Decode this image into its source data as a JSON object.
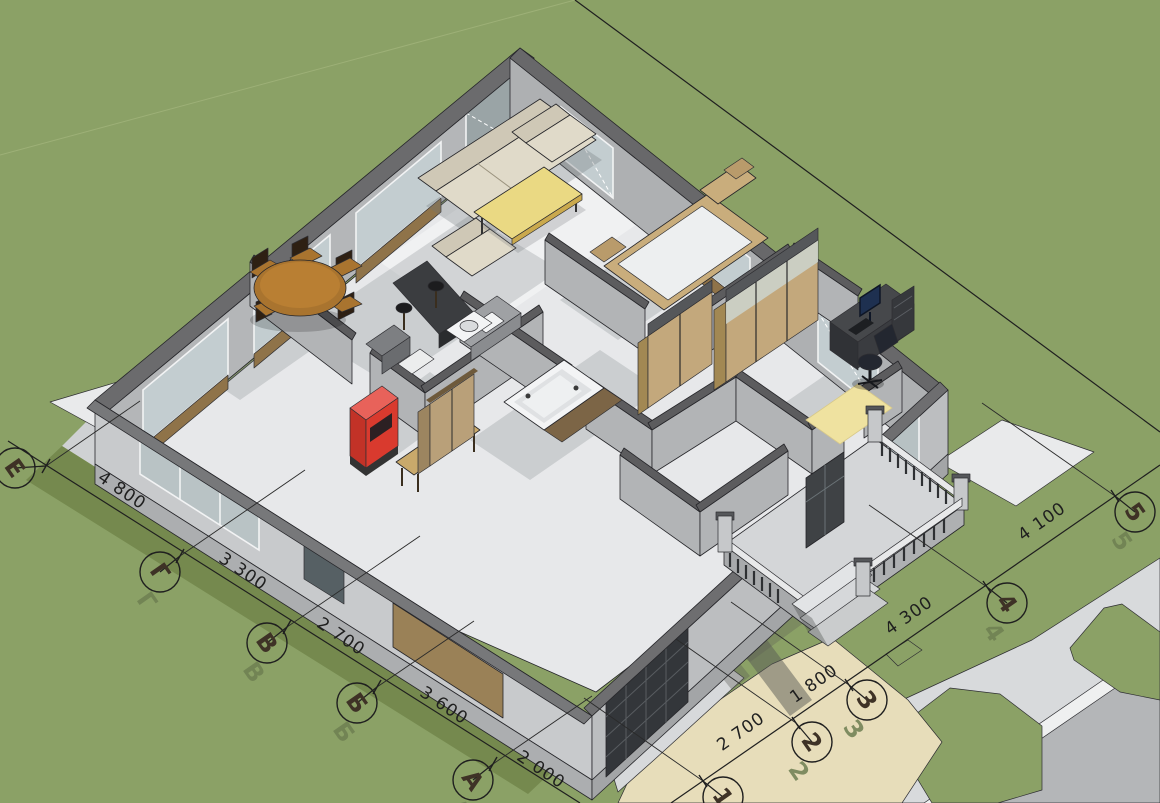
{
  "dimension_labels": {
    "left_chain": [
      "4 800",
      "3 300",
      "2 700",
      "3 600",
      "2 000"
    ],
    "bottom_chain": [
      "2 700",
      "1 800",
      "4 300",
      "4 100"
    ]
  },
  "axis_markers": {
    "left_chain": [
      "Е",
      "Г",
      "В",
      "Б",
      "А"
    ],
    "bottom_chain": [
      "1",
      "2",
      "3",
      "4",
      "5"
    ]
  },
  "colors": {
    "grass": "#8BA166",
    "grass_shadow": "#75894E",
    "path": "#D8DADC",
    "road": "#B4B6B8",
    "driveway": "#E7DDBA",
    "wall_outer": "#C8CACC",
    "wall_inner": "#B4B6B8",
    "wall_cap": "#6B6B6D",
    "floor": "#E7E8EA",
    "wood": "#C3A87C",
    "accent_yellow": "#EAD983",
    "accent_red": "#D93A2E",
    "ink": "#1F1F1F"
  }
}
